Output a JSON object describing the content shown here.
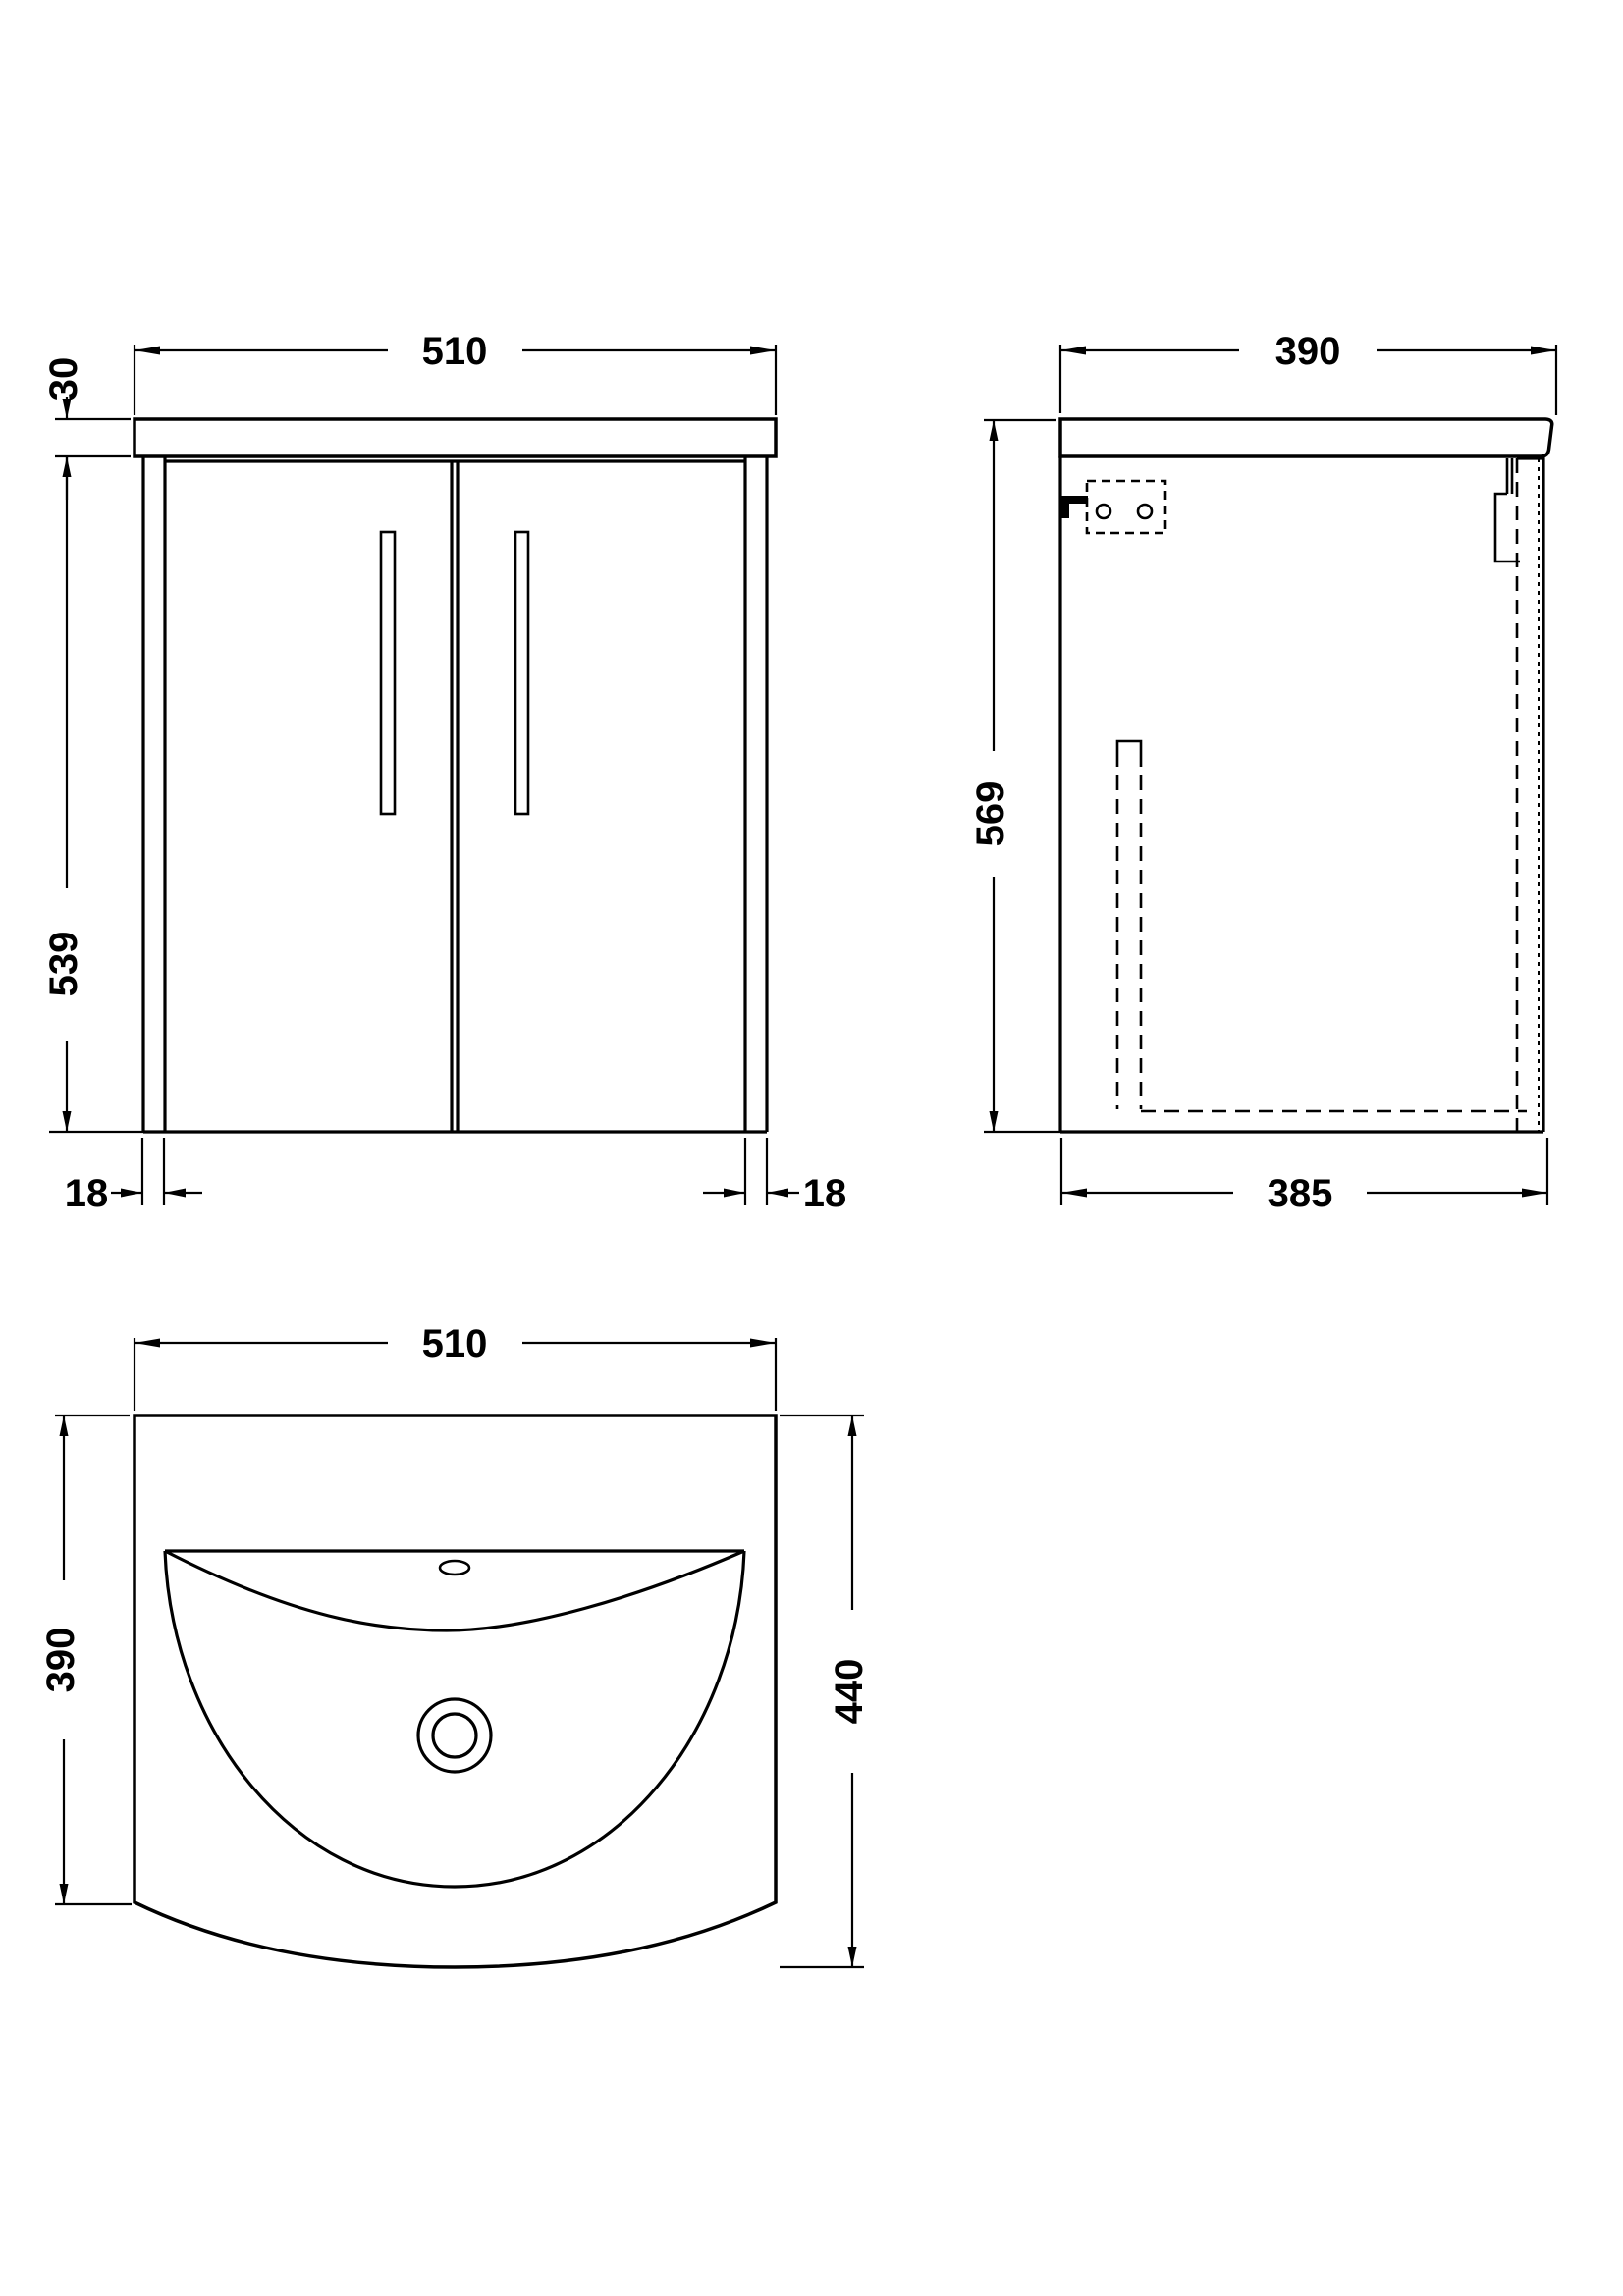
{
  "drawing_type": "bathroom vanity unit with basin - dimensioned CAD drawing",
  "units": "mm",
  "views": {
    "front": {
      "label": "front elevation",
      "dims": {
        "width": "510",
        "worktop_thickness": "30",
        "cabinet_height": "539",
        "left_panel_thickness": "18",
        "right_panel_thickness": "18"
      }
    },
    "side": {
      "label": "side elevation",
      "dims": {
        "worktop_depth": "390",
        "overall_height": "569",
        "cabinet_depth": "385"
      }
    },
    "plan": {
      "label": "basin plan view",
      "dims": {
        "width": "510",
        "basin_depth": "390",
        "overall_depth": "440"
      }
    }
  },
  "colors": {
    "line": "#000000",
    "background": "#ffffff"
  }
}
